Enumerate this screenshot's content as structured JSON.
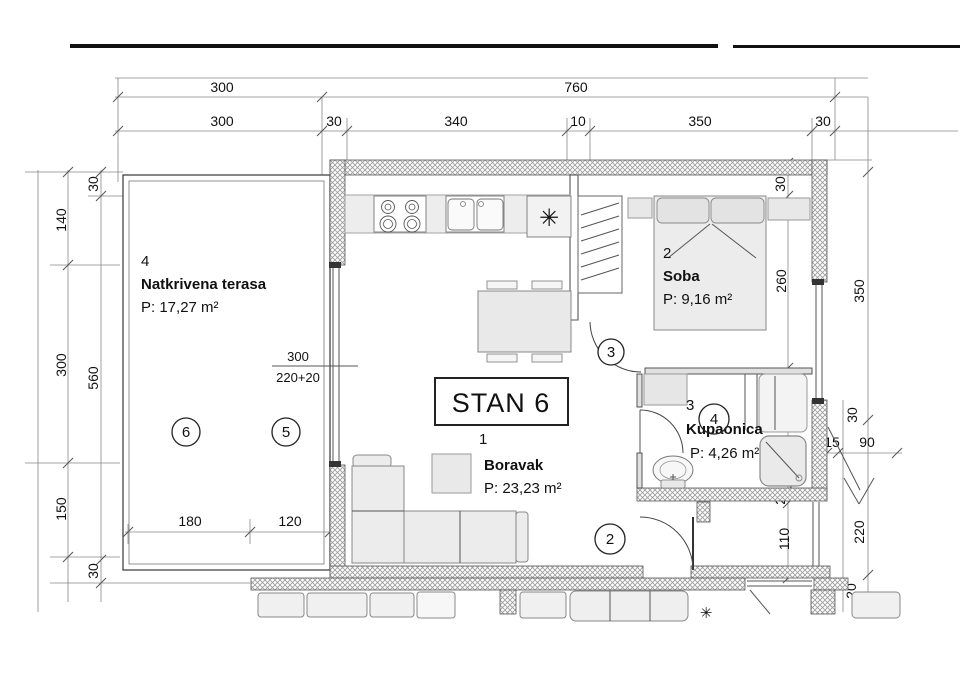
{
  "plan": {
    "title": "STAN 6",
    "rooms": {
      "terrace": {
        "num": "4",
        "name": "Natkrivena terasa",
        "area": "P: 17,27 m²"
      },
      "living": {
        "num": "1",
        "name": "Boravak",
        "area": "P: 23,23 m²"
      },
      "bedroom": {
        "num": "2",
        "name": "Soba",
        "area": "P: 9,16 m²"
      },
      "bathroom": {
        "num": "3",
        "name": "Kupaonica",
        "area": "P: 4,26 m²"
      }
    },
    "markers": {
      "entry": "2",
      "bedroom_door": "3",
      "bath": "4",
      "terrace_right": "5",
      "terrace_left": "6"
    },
    "dims": {
      "top1": [
        "300",
        "760"
      ],
      "top2": [
        "300",
        "30",
        "340",
        "10",
        "350",
        "30"
      ],
      "left_outer": [
        "140",
        "300",
        "150"
      ],
      "left_inner": [
        "30",
        "560",
        "30"
      ],
      "terrace_bottom": [
        "180",
        "120"
      ],
      "right_col": [
        "30",
        "260",
        "170",
        "20",
        "110"
      ],
      "right_outer": [
        "350",
        "220"
      ],
      "side": [
        "30",
        "15",
        "90",
        "20"
      ],
      "window": {
        "w": "300",
        "h": "220+20"
      }
    },
    "icons": {
      "appliance": "✳"
    }
  }
}
